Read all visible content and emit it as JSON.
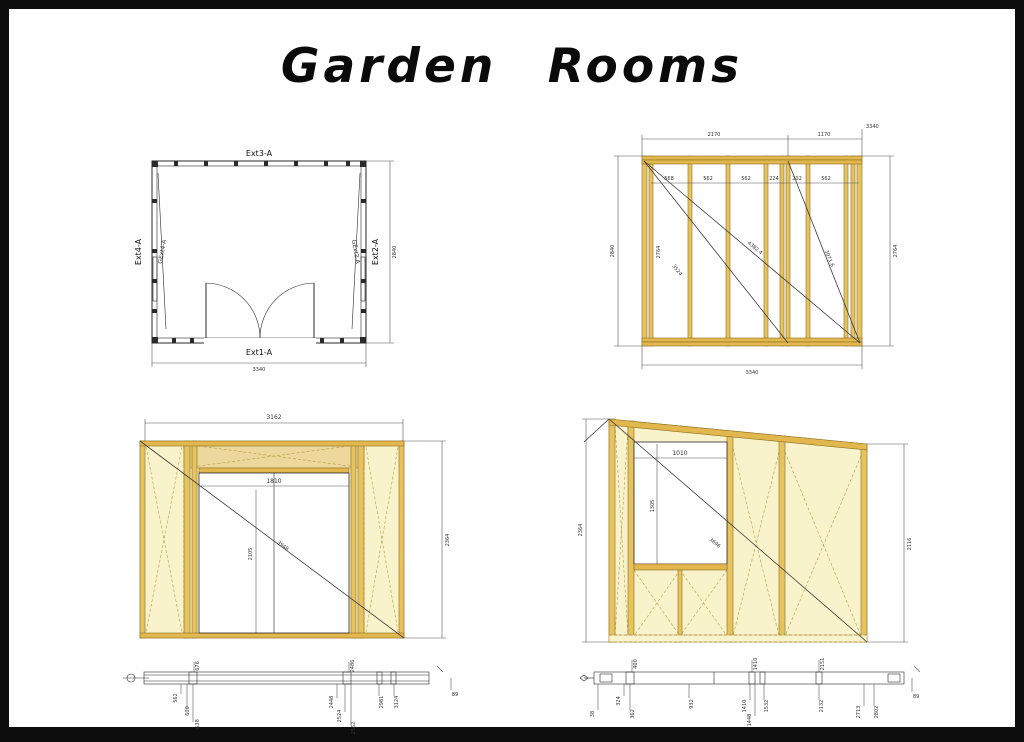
{
  "page": {
    "title": "Garden Rooms"
  },
  "colors": {
    "stud_gold": "#e7c35f",
    "panel_cream": "#f8f3ca",
    "header_tan": "#ecd79c",
    "line": "#2a2a2a"
  },
  "floor_plan": {
    "label_top": "Ext3-A",
    "label_bottom": "Ext1-A",
    "label_left": "Ext4-A",
    "label_right": "Ext2-A",
    "label_gable_left": "GExt4-A",
    "label_gable_right": "GExt2-A",
    "dim_width": "3340",
    "dim_depth": "2840"
  },
  "framing_elevation": {
    "dim_top_left": "2170",
    "dim_top_right": "1170",
    "dim_overall": "3340",
    "stud_spacings": [
      "568",
      "562",
      "562",
      "224",
      "202",
      "562"
    ],
    "dim_left_height": "2840",
    "dim_right_height": "2764",
    "dim_stud_height": "2764",
    "dim_diag_full": "4382.4",
    "dim_diag_left": "3524",
    "dim_diag_right": "3071.6",
    "dim_bottom": "3340"
  },
  "door_elevation": {
    "dim_top": "3162",
    "dim_opening_width": "1810",
    "dim_opening_height": "2105",
    "dim_diag": "3948",
    "dim_right_height": "2364",
    "strip": {
      "above": [
        "676",
        "2486"
      ],
      "below": [
        "562",
        "600",
        "638",
        "2448",
        "2524",
        "2562",
        "2981",
        "3124"
      ],
      "dim_right": "89"
    }
  },
  "side_elevation": {
    "dim_left_height": "2364",
    "dim_bottom": "2840",
    "dim_window_width": "1010",
    "dim_window_height": "1305",
    "dim_diag": "3696",
    "dim_right_height": "2116",
    "strip": {
      "above": [
        "400",
        "1410",
        "2151"
      ],
      "below": [
        "38",
        "324",
        "362",
        "932",
        "1410",
        "1448",
        "1532",
        "2132",
        "2713",
        "2802"
      ],
      "dim_right": "89"
    }
  }
}
